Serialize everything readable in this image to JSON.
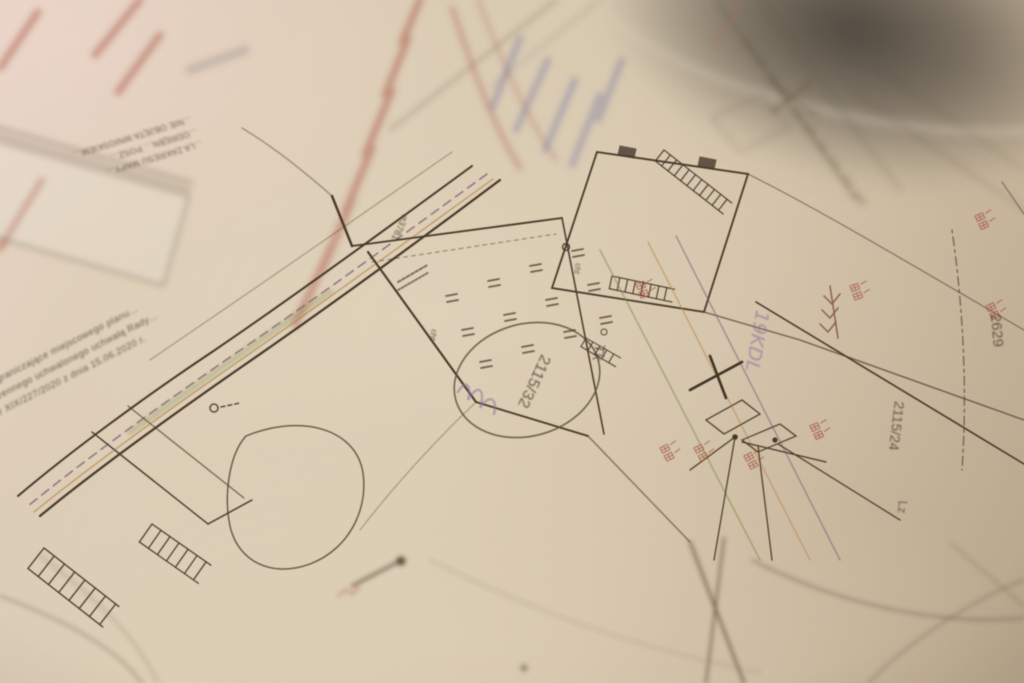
{
  "map_labels": [
    {
      "id": "parcel-2115-32",
      "text": "2115/32"
    },
    {
      "id": "parcel-2115-24",
      "text": "2115/24"
    },
    {
      "id": "parcel-2629",
      "text": "2629"
    },
    {
      "id": "road-3781",
      "text": "⌀3781"
    },
    {
      "id": "use-tk",
      "text": "Tk"
    },
    {
      "id": "use-lz",
      "text": "Lz"
    },
    {
      "id": "use-cht-1",
      "text": "cht"
    },
    {
      "id": "use-cht-2",
      "text": "cht"
    },
    {
      "id": "plan-19kdl",
      "text": "19KDL"
    }
  ],
  "printed_note": {
    "lines": [
      "…ograniczające miejscowego planu…",
      "…zennego uchwalonego uchwałą Rady…",
      "nr XIX/227/2020 z dnia 15.06.2020 r."
    ]
  },
  "info_box": {
    "lines": [
      "…LA ZAKRESU MAPY…",
      "…ODRĘBN… POSZ…",
      "…NIE OBJĘTA WNIOSKIEM…"
    ]
  },
  "colors": {
    "paper": "#d7c8af",
    "paper_dark": "#b7a58b",
    "ink": "#46392b",
    "ink_faint": "#7a6a55",
    "stamp_red": "#a85848",
    "ink_blue": "#7a74a2",
    "centerline_purple": "#7d5b74",
    "utility_orange": "#b5854e",
    "vegetation_green": "#7d8a4a",
    "annotation_red": "#9e4a3c",
    "label_olive": "#5a523a"
  }
}
